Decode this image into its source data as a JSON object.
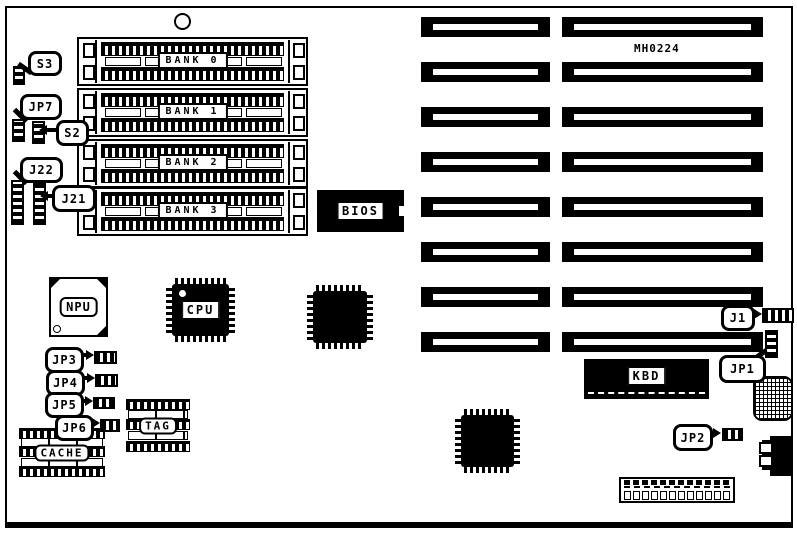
{
  "part_number": "MH0224",
  "memory_banks": [
    {
      "label": "BANK 0"
    },
    {
      "label": "BANK 1"
    },
    {
      "label": "BANK 2"
    },
    {
      "label": "BANK 3"
    }
  ],
  "chips": {
    "bios": {
      "label": "BIOS"
    },
    "npu": {
      "label": "NPU"
    },
    "cpu": {
      "label": "CPU"
    },
    "kbd": {
      "label": "KBD"
    },
    "tag": {
      "label": "TAG"
    },
    "cache": {
      "label": "CACHE"
    }
  },
  "callouts": {
    "s3": {
      "label": "S3"
    },
    "jp7": {
      "label": "JP7"
    },
    "s2": {
      "label": "S2"
    },
    "j22": {
      "label": "J22"
    },
    "j21": {
      "label": "J21"
    },
    "jp3": {
      "label": "JP3"
    },
    "jp4": {
      "label": "JP4"
    },
    "jp5": {
      "label": "JP5"
    },
    "jp6": {
      "label": "JP6"
    },
    "j1": {
      "label": "J1"
    },
    "jp1": {
      "label": "JP1"
    },
    "jp2": {
      "label": "JP2"
    }
  },
  "expansion_slots": {
    "rows": 8,
    "columns": 2,
    "total": 16
  },
  "colors": {
    "ink": "#000000",
    "paper": "#ffffff"
  }
}
